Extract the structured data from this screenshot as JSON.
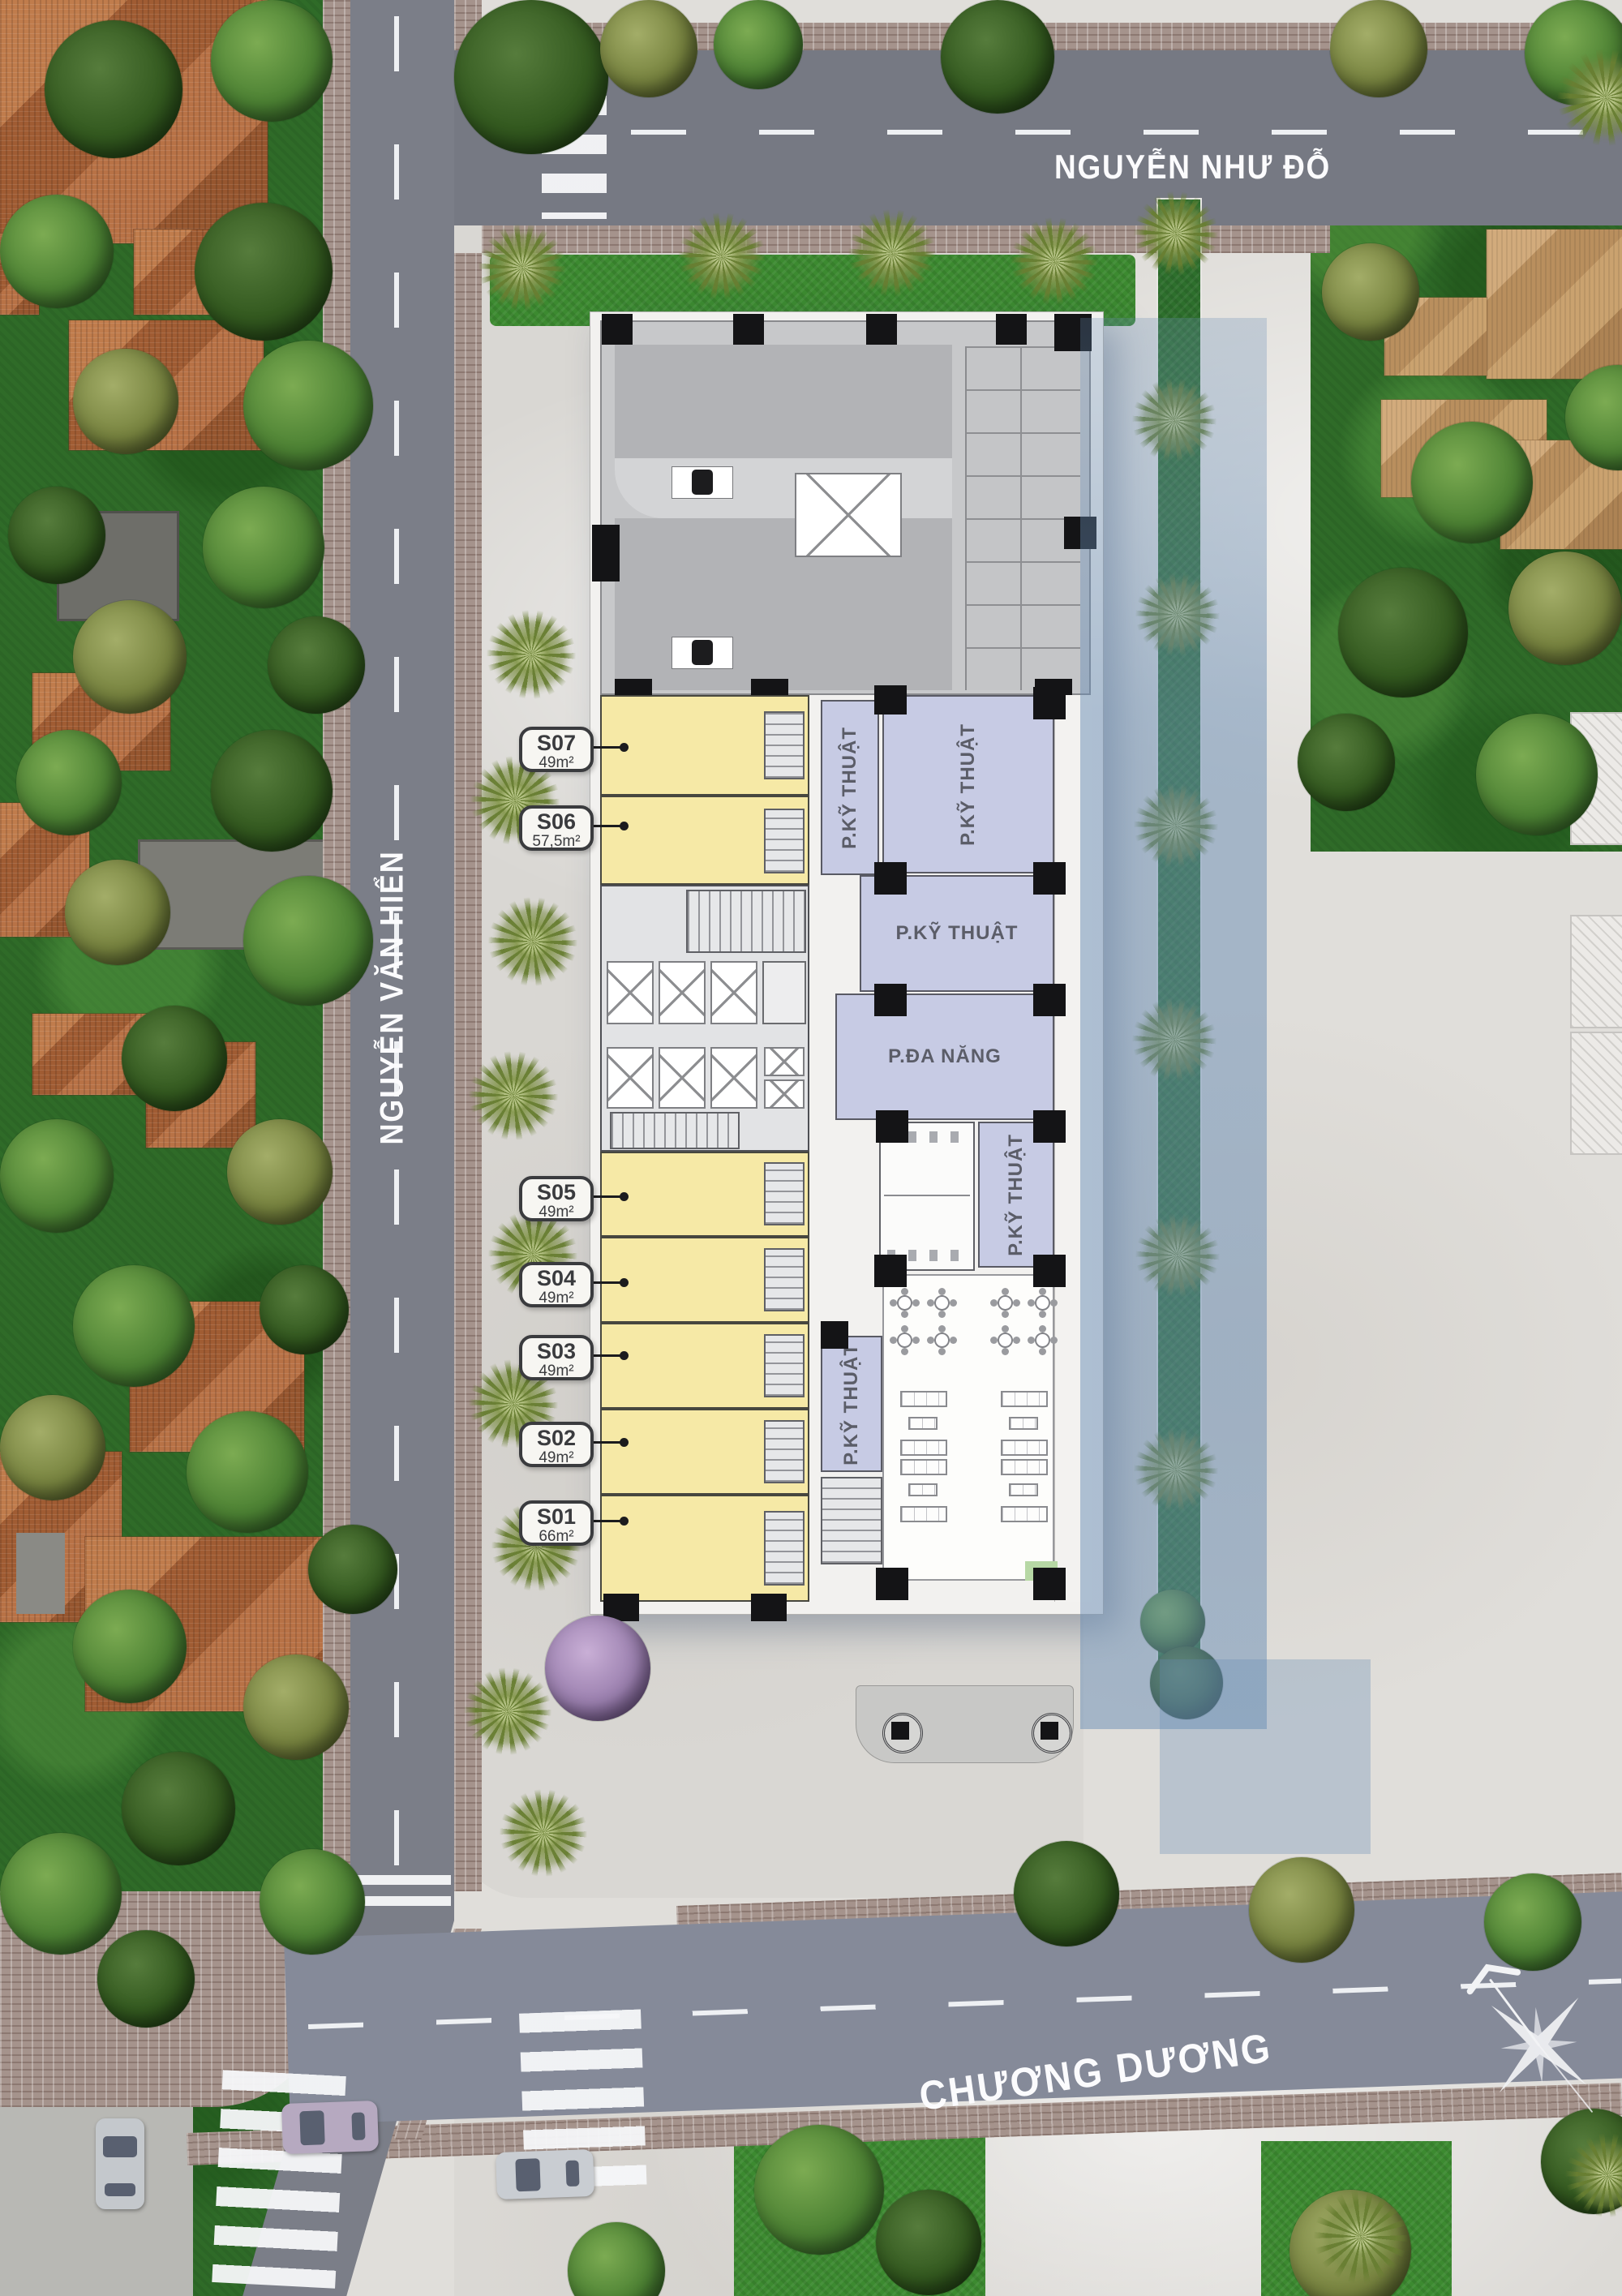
{
  "streets": {
    "top": "NGUYỄN NHƯ ĐỖ",
    "left": "NGUYỄN VĂN HIỂN",
    "bottom": "CHƯƠNG DƯƠNG"
  },
  "units": [
    {
      "id": "S07",
      "area": "49m²"
    },
    {
      "id": "S06",
      "area": "57,5m²"
    },
    {
      "id": "S05",
      "area": "49m²"
    },
    {
      "id": "S04",
      "area": "49m²"
    },
    {
      "id": "S03",
      "area": "49m²"
    },
    {
      "id": "S02",
      "area": "49m²"
    },
    {
      "id": "S01",
      "area": "66m²"
    }
  ],
  "rooms": {
    "technical": "P.KỸ THUẬT",
    "multipurpose": "P.ĐA NĂNG"
  },
  "colors": {
    "unit_fill": "#f6e9a6",
    "technical_fill": "#c7cbe4",
    "road": "#797c86",
    "grass": "#3c8a30",
    "brick_sidewalk": "#a5938c",
    "plaza": "#e0deda",
    "water_overlay": "#688cb4",
    "roof_terracotta": "#b06e41",
    "label_text": "#3a3b3e",
    "street_text": "#fbfbfd"
  }
}
